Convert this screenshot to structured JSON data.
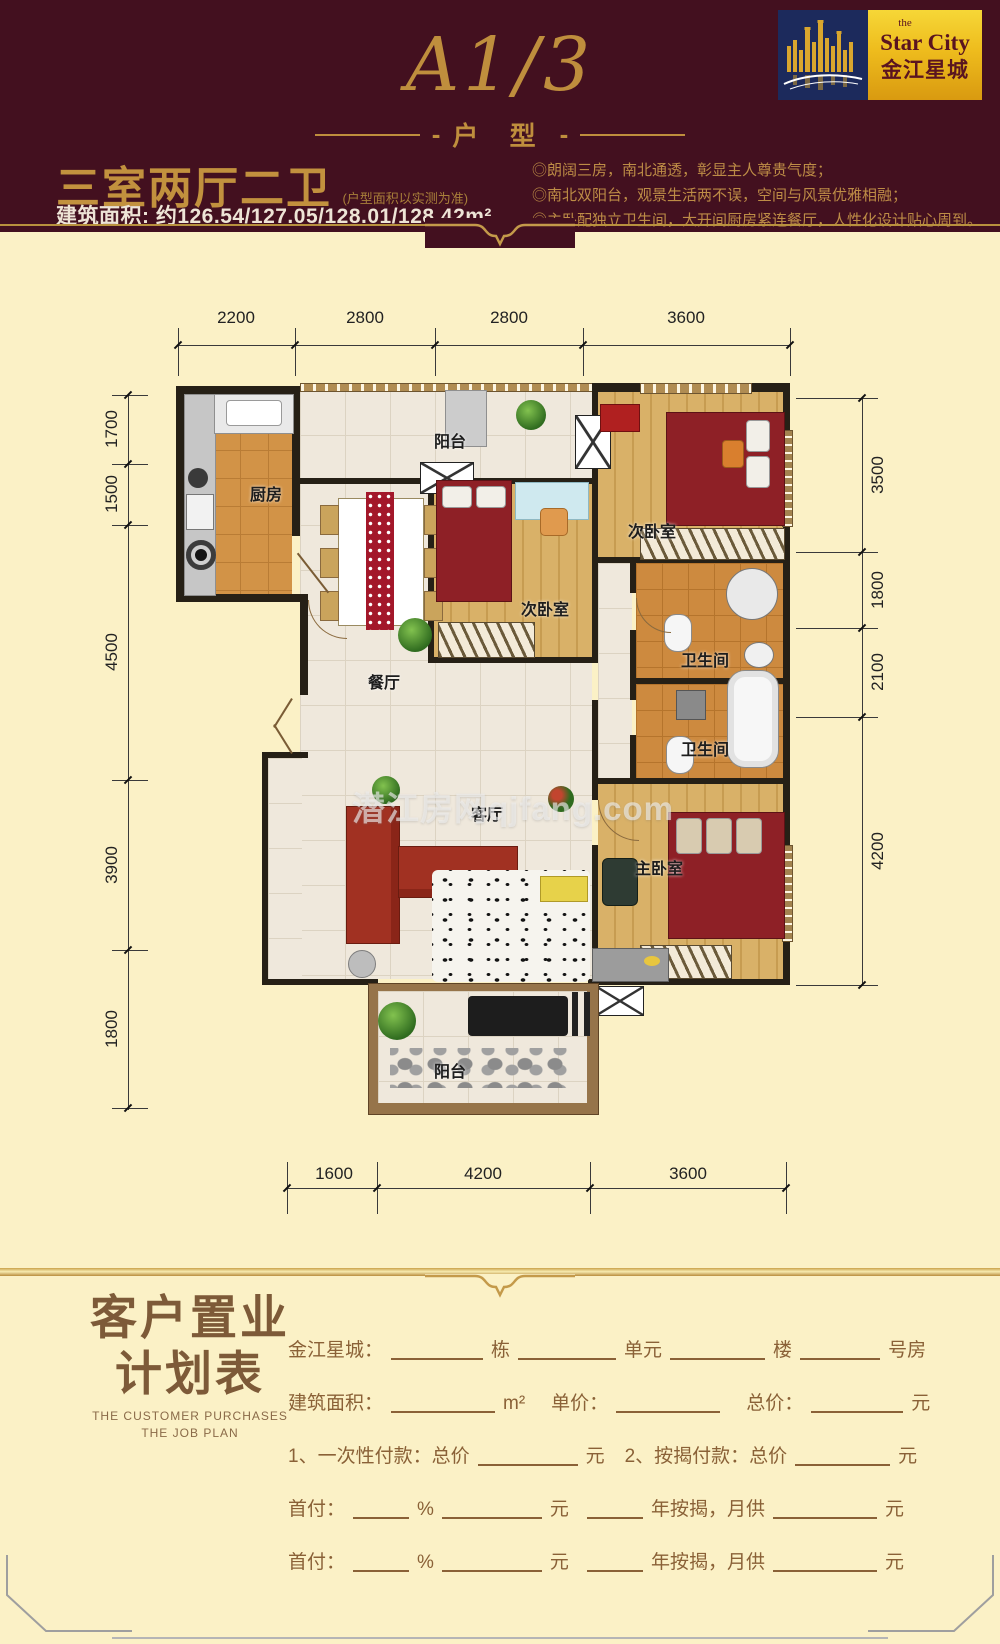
{
  "logo": {
    "the": "the",
    "name_en": "Star City",
    "name_cn": "金江星城",
    "skyline_icon": "city-skyline-icon"
  },
  "header": {
    "unit_code": "A1/3",
    "unit_label": "户 型",
    "title": "三室两厅二卫",
    "title_note": "(户型面积以实测为准)",
    "area": "建筑面积: 约126.54/127.05/128.01/128.42m²",
    "features": [
      "◎朗阔三房，南北通透，彰显主人尊贵气度；",
      "◎南北双阳台，观景生活两不误，空间与风景优雅相融；",
      "◎主卧配独立卫生间，大开间厨房紧连餐厅，人性化设计贴心周到。"
    ]
  },
  "floorplan": {
    "watermark": "潜江房网qjfang.com",
    "rooms": {
      "balcony_top": "阳台",
      "kitchen": "厨房",
      "bedroom_right": "次卧室",
      "bedroom_mid": "次卧室",
      "bath_top": "卫生间",
      "bath_bottom": "卫生间",
      "dining": "餐厅",
      "living": "客厅",
      "master": "主卧室",
      "balcony_bottom": "阳台"
    },
    "dims": {
      "top": [
        "2200",
        "2800",
        "2800",
        "3600"
      ],
      "left": [
        "1700",
        "1500",
        "4500",
        "3900",
        "1800"
      ],
      "right": [
        "3500",
        "1800",
        "2100",
        "4200"
      ],
      "bottom": [
        "1600",
        "4200",
        "3600"
      ]
    }
  },
  "form": {
    "title_line1": "客户置业",
    "title_line2": "计划表",
    "subtitle1": "THE CUSTOMER PURCHASES",
    "subtitle2": "THE JOB PLAN",
    "rows": [
      [
        {
          "t": "金江星城："
        },
        {
          "b": 92
        },
        {
          "t": "栋"
        },
        {
          "b": 98
        },
        {
          "t": "单元"
        },
        {
          "b": 95
        },
        {
          "t": "楼"
        },
        {
          "b": 80
        },
        {
          "t": "号房"
        }
      ],
      [
        {
          "t": "建筑面积："
        },
        {
          "b": 104
        },
        {
          "t": "m²"
        },
        {
          "g": 22
        },
        {
          "t": "单价："
        },
        {
          "b": 104
        },
        {
          "g": 18
        },
        {
          "t": "总价："
        },
        {
          "b": 92
        },
        {
          "t": "元"
        }
      ],
      [
        {
          "t": "1、一次性付款：总价"
        },
        {
          "b": 100
        },
        {
          "t": "元"
        },
        {
          "g": 16
        },
        {
          "t": "2、按揭付款：总价"
        },
        {
          "b": 95
        },
        {
          "t": "元"
        }
      ],
      [
        {
          "t": "首付："
        },
        {
          "b": 56
        },
        {
          "t": "%"
        },
        {
          "b": 100
        },
        {
          "t": "元"
        },
        {
          "g": 10
        },
        {
          "b": 56
        },
        {
          "t": "年按揭，月供"
        },
        {
          "b": 104
        },
        {
          "t": "元"
        }
      ],
      [
        {
          "t": "首付："
        },
        {
          "b": 56
        },
        {
          "t": "%"
        },
        {
          "b": 100
        },
        {
          "t": "元"
        },
        {
          "g": 10
        },
        {
          "b": 56
        },
        {
          "t": "年按揭，月供"
        },
        {
          "b": 104
        },
        {
          "t": "元"
        }
      ]
    ]
  },
  "colors": {
    "maroon": "#43101f",
    "gold": "#bf8e3d",
    "cream": "#fbf1c6",
    "form_brown": "#8a6137",
    "logo_navy": "#1c2a5c",
    "logo_gold": "#eebc1d",
    "bed_red": "#8e2026",
    "wood": "#d9b168",
    "bath_tile": "#cd8a3f"
  }
}
